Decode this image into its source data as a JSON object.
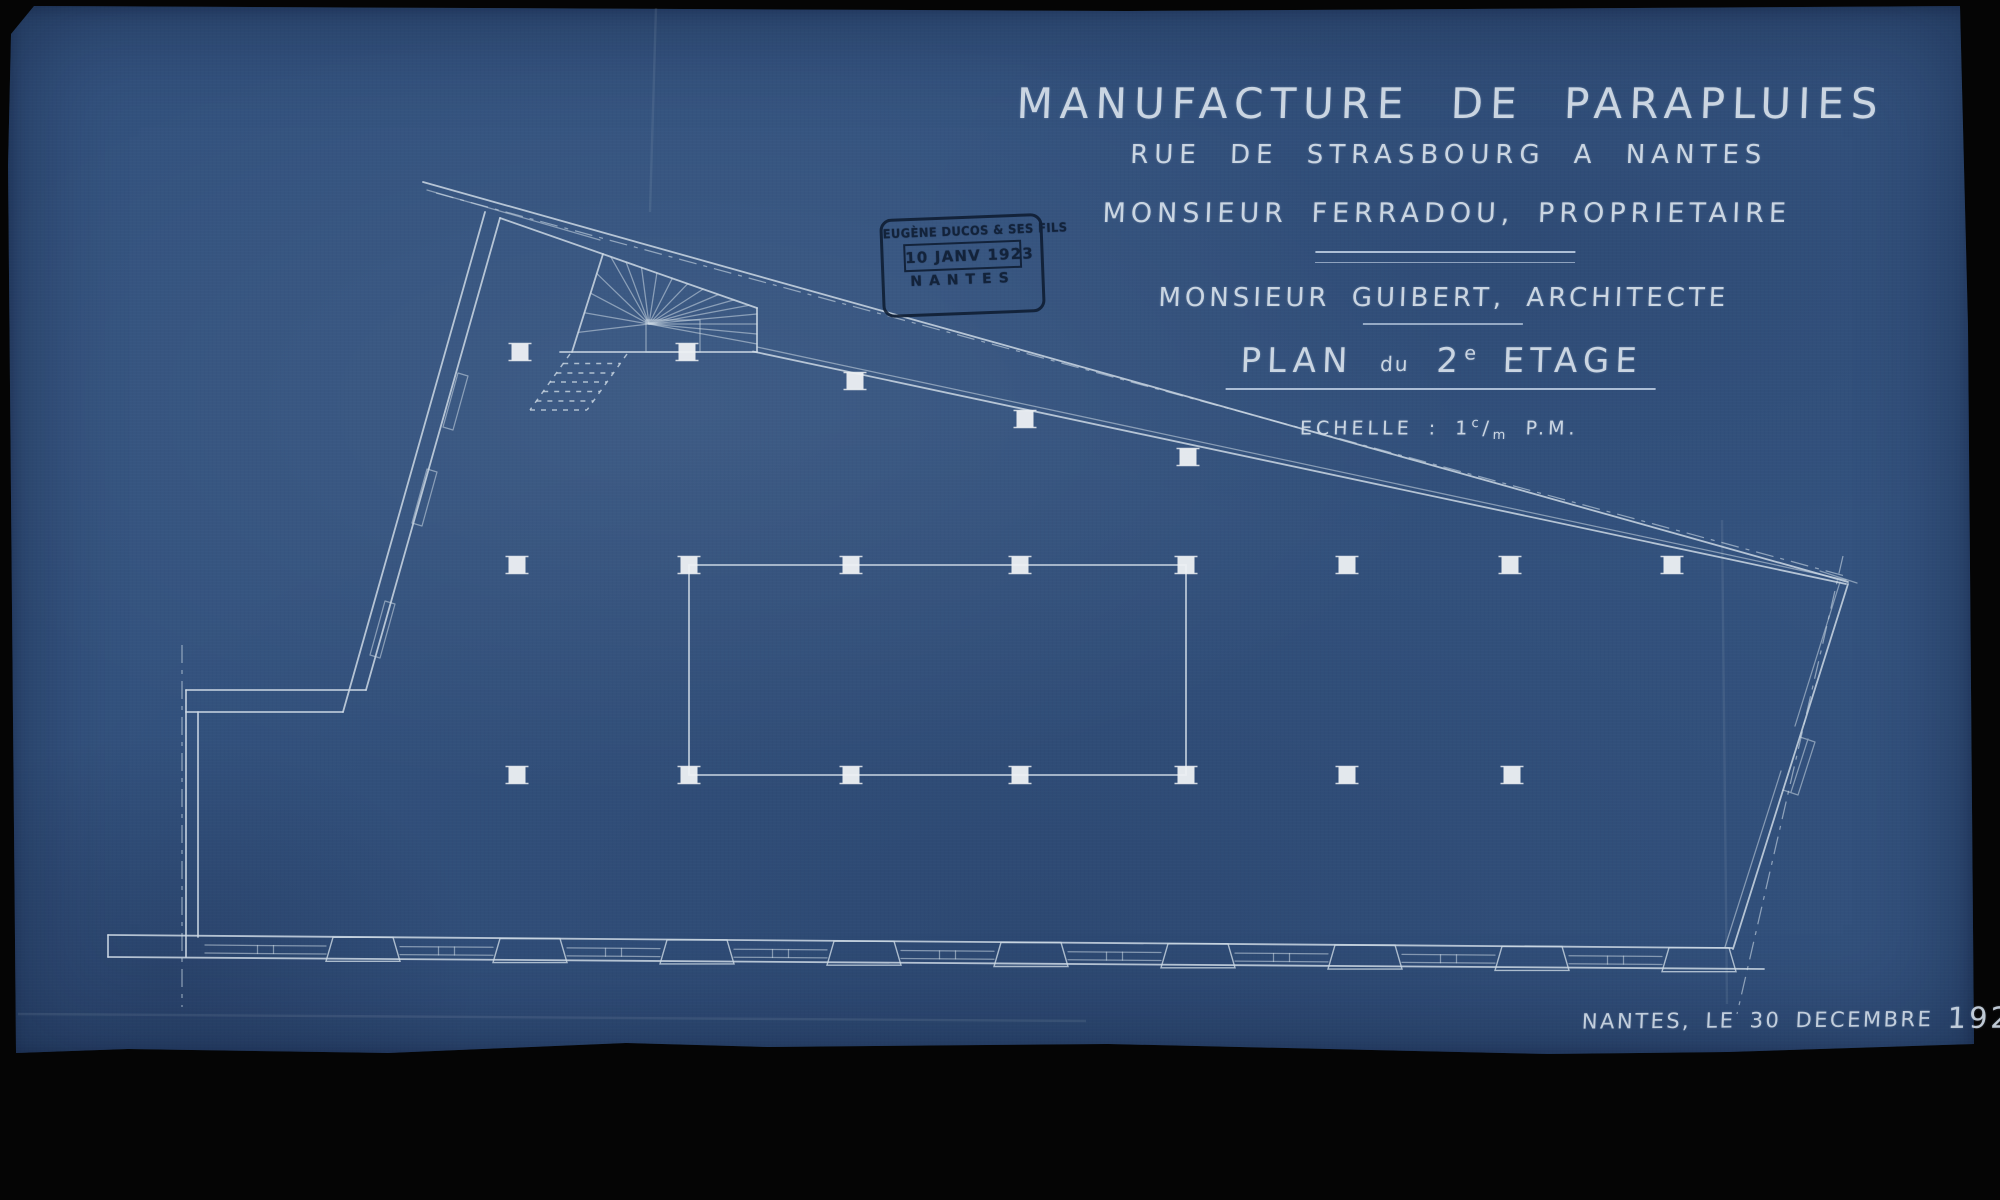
{
  "colors": {
    "paper_blue": "#33527e",
    "paper_edge": "#2a4570",
    "drawing_line": "#ccd8e4",
    "column_white": "#edf0f3",
    "stamp_ink": "#0e1c31",
    "scan_background": "#050505"
  },
  "title_block": {
    "line1": "MANUFACTURE DE PARAPLUIES",
    "line2": "RUE DE STRASBOURG A NANTES",
    "line3": "MONSIEUR FERRADOU, PROPRIETAIRE",
    "line4": "MONSIEUR GUIBERT, ARCHITECTE",
    "plan_title": {
      "word1": "PLAN",
      "word2": "du",
      "floor_number": "2",
      "floor_sup": "e",
      "word3": "ETAGE"
    },
    "scale_line": {
      "label": "ECHELLE :",
      "number": "1",
      "numerator": "c",
      "slash": "/",
      "denominator": "m",
      "unit": "P.M."
    }
  },
  "stamp": {
    "company": "EUGÈNE DUCOS & SES FILS",
    "date": "10 JANV 1923",
    "city": "NANTES"
  },
  "footer": {
    "place_and_date": "NANTES, LE 30 DECEMBRE",
    "year": "1922"
  }
}
